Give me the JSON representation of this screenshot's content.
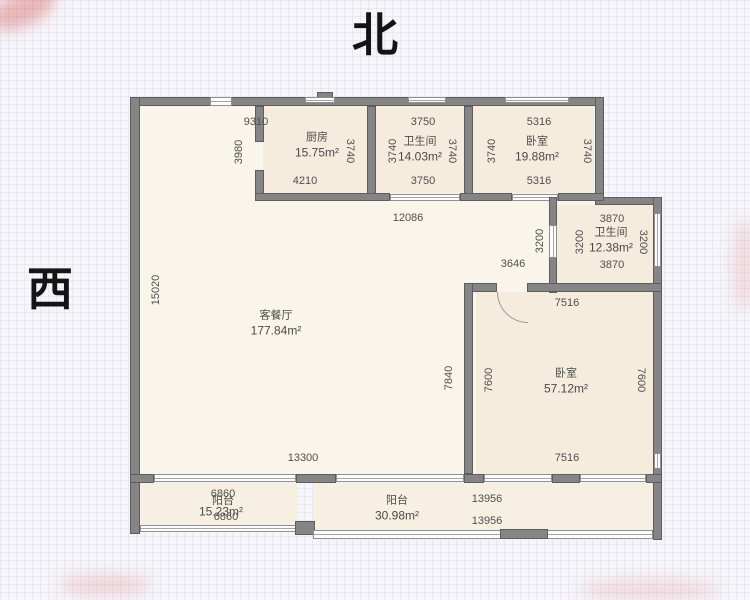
{
  "compass": {
    "north": "北",
    "west": "西"
  },
  "rooms": {
    "kitchen": {
      "name": "厨房",
      "area": "15.75m²"
    },
    "bath_top": {
      "name": "卫生间",
      "area": "14.03m²"
    },
    "bedroom_top": {
      "name": "卧室",
      "area": "19.88m²"
    },
    "bath_mid": {
      "name": "卫生间",
      "area": "12.38m²"
    },
    "living": {
      "name": "客餐厅",
      "area": "177.84m²"
    },
    "bedroom_main": {
      "name": "卧室",
      "area": "57.12m²"
    },
    "balcony_left": {
      "name": "阳台",
      "area": "15.23m²"
    },
    "balcony_right": {
      "name": "阳台",
      "area": "30.98m²"
    }
  },
  "dims": [
    "9310",
    "3980",
    "4210",
    "3740",
    "3750",
    "3740",
    "3740",
    "3750",
    "5316",
    "3740",
    "3740",
    "5316",
    "12086",
    "15020",
    "3646",
    "3200",
    "3870",
    "3200",
    "3200",
    "3870",
    "7516",
    "7840",
    "7600",
    "7600",
    "7516",
    "13300",
    "6860",
    "6860",
    "13956",
    "13956"
  ],
  "colors": {
    "wall": "#858585",
    "floor_living": "#faf5ea",
    "floor_room": "#f6ecdd",
    "background": "#f6f5f9",
    "text": "#4a4a4a"
  }
}
